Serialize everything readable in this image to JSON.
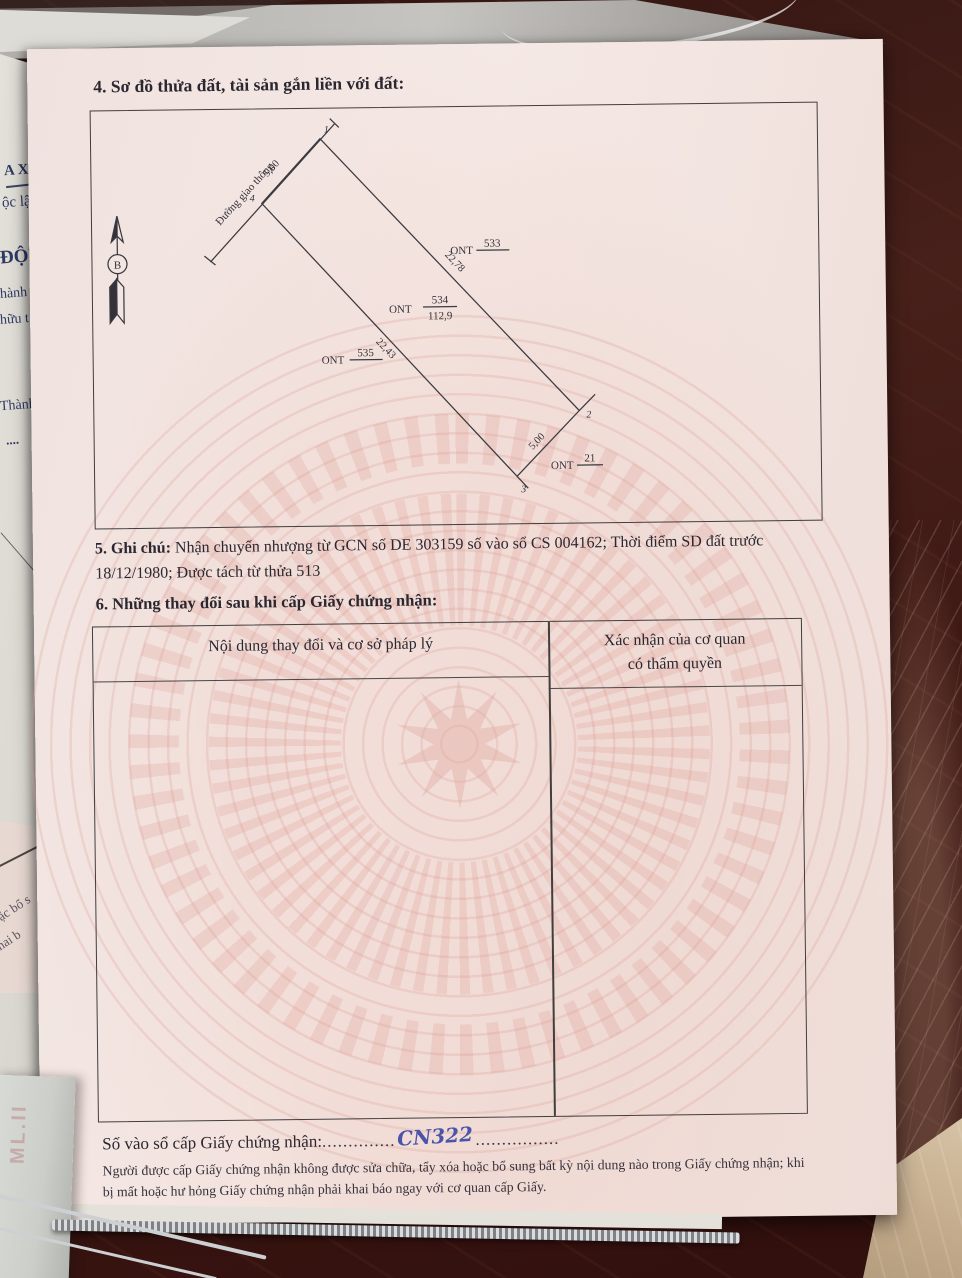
{
  "document": {
    "section4": {
      "title": "4. Sơ đồ thửa đất, tài sản gắn liền với đất:"
    },
    "section5": {
      "label": "5. Ghi chú:",
      "text": "Nhận chuyển nhượng từ GCN số DE 303159 số vào sổ CS 004162; Thời điểm SD đất trước 18/12/1980; Được tách từ thửa 513"
    },
    "section6": {
      "title": "6. Những thay đổi sau khi cấp Giấy chứng nhận:",
      "table": {
        "col1_header": "Nội dung thay đổi và cơ sở pháp lý",
        "col2_header_line1": "Xác nhận của cơ quan",
        "col2_header_line2": "có thẩm quyền",
        "rows": []
      }
    },
    "registry": {
      "label": "Số vào sổ cấp Giấy chứng nhận:",
      "leader_dots_left": "..............",
      "handwritten_value": "CN322",
      "leader_dots_right": "................"
    },
    "footer_note": "Người được cấp Giấy chứng nhận không được sửa chữa, tẩy xóa hoặc bổ sung bất kỳ nội dung nào trong Giấy chứng nhận; khi bị mất hoặc hư hỏng Giấy chứng nhận phải khai báo ngay với cơ quan cấp Giấy."
  },
  "diagram": {
    "road_label": "Đường giao thông",
    "north_marker": "B",
    "dimensions": {
      "top_edge": "5,00",
      "right_edge": "22,78",
      "left_edge": "22,43",
      "bottom_edge": "5,00"
    },
    "parcel": {
      "land_use_code": "ONT",
      "plot_number": "534",
      "area": "112,9"
    },
    "adjacent_plots": {
      "right": {
        "code": "ONT",
        "number": "533"
      },
      "left": {
        "code": "ONT",
        "number": "535"
      },
      "bottom": {
        "code": "ONT",
        "number": "21"
      }
    },
    "corner_points": {
      "p1": "1",
      "p2": "2",
      "p3": "3",
      "p4": "4"
    }
  },
  "background": {
    "underlying_paper_fragments": [
      "A XÃ",
      "ộc lập",
      "ĐỘN",
      "hành",
      "hữu t",
      "Thành",
      "...."
    ],
    "bottom_left_fragments": [
      "ặc bổ s",
      "khai b"
    ],
    "folder_label": "ML.II"
  },
  "colors": {
    "paper_pink": "#f3e5e1",
    "watermark_pink": "#dd9e94",
    "table_wood": "#41180f",
    "floor_beige": "#c7ae8f",
    "handwriting_blue": "#4a55a8",
    "ink_black": "#2b2730",
    "underlay_ink_blue": "#2e3a64"
  }
}
